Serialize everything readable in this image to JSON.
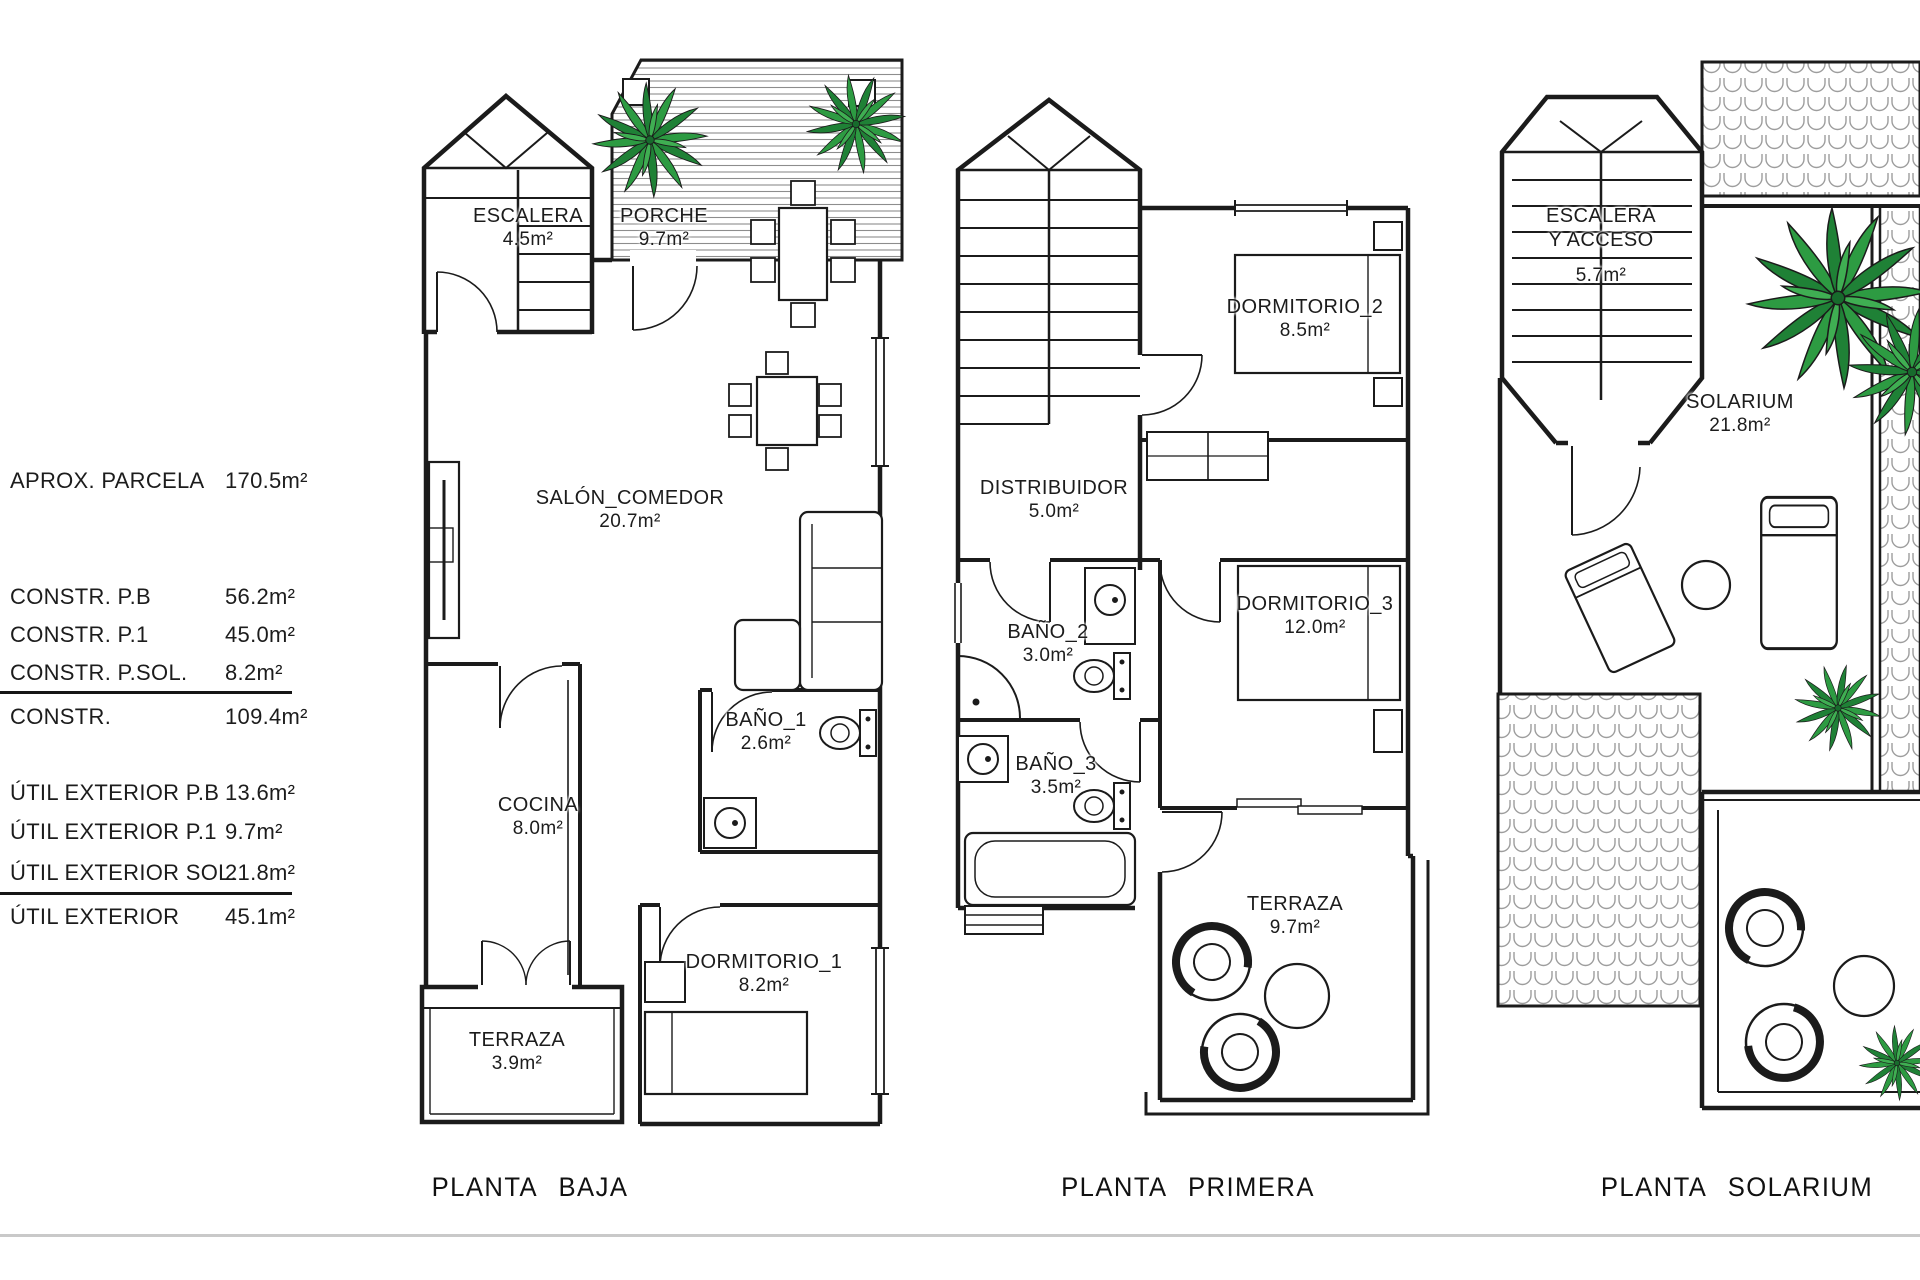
{
  "legend": {
    "rows": [
      {
        "label": "APROX. PARCELA",
        "value": "170.5m²"
      },
      {
        "label": "CONSTR.  P.B",
        "value": "56.2m²"
      },
      {
        "label": "CONSTR.  P.1",
        "value": "45.0m²"
      },
      {
        "label": "CONSTR.  P.SOL.",
        "value": "8.2m²"
      },
      {
        "label": "CONSTR.",
        "value": "109.4m²"
      },
      {
        "label": "ÚTIL EXTERIOR P.B",
        "value": "13.6m²"
      },
      {
        "label": "ÚTIL EXTERIOR P.1",
        "value": "9.7m²"
      },
      {
        "label": "ÚTIL EXTERIOR SOL.",
        "value": "21.8m²"
      },
      {
        "label": "ÚTIL EXTERIOR",
        "value": "45.1m²"
      }
    ]
  },
  "plans": {
    "baja": {
      "caption": "PLANTA BAJA",
      "rooms": {
        "escalera": {
          "name": "ESCALERA",
          "area": "4.5m²"
        },
        "porche": {
          "name": "PORCHE",
          "area": "9.7m²"
        },
        "salon": {
          "name": "SALÓN_COMEDOR",
          "area": "20.7m²"
        },
        "bano1": {
          "name": "BAÑO_1",
          "area": "2.6m²"
        },
        "cocina": {
          "name": "COCINA",
          "area": "8.0m²"
        },
        "dormitorio1": {
          "name": "DORMITORIO_1",
          "area": "8.2m²"
        },
        "terraza": {
          "name": "TERRAZA",
          "area": "3.9m²"
        }
      }
    },
    "primera": {
      "caption": "PLANTA PRIMERA",
      "rooms": {
        "dormitorio2": {
          "name": "DORMITORIO_2",
          "area": "8.5m²"
        },
        "distribuidor": {
          "name": "DISTRIBUIDOR",
          "area": "5.0m²"
        },
        "bano2": {
          "name": "BAÑO_2",
          "area": "3.0m²"
        },
        "dormitorio3": {
          "name": "DORMITORIO_3",
          "area": "12.0m²"
        },
        "bano3": {
          "name": "BAÑO_3",
          "area": "3.5m²"
        },
        "terraza": {
          "name": "TERRAZA",
          "area": "9.7m²"
        }
      }
    },
    "solarium": {
      "caption": "PLANTA SOLARIUM",
      "rooms": {
        "escalera": {
          "name_line1": "ESCALERA",
          "name_line2": "Y ACCESO",
          "area": "5.7m²"
        },
        "solarium": {
          "name": "SOLARIUM",
          "area": "21.8m²"
        }
      }
    }
  },
  "colors": {
    "wall_line": "#1b1b1b",
    "palm_green": "#2d9b42",
    "tile_gray": "#9d9d9d",
    "deck_gray": "#8d8d8d",
    "divider_gray": "#c9c9c9"
  }
}
